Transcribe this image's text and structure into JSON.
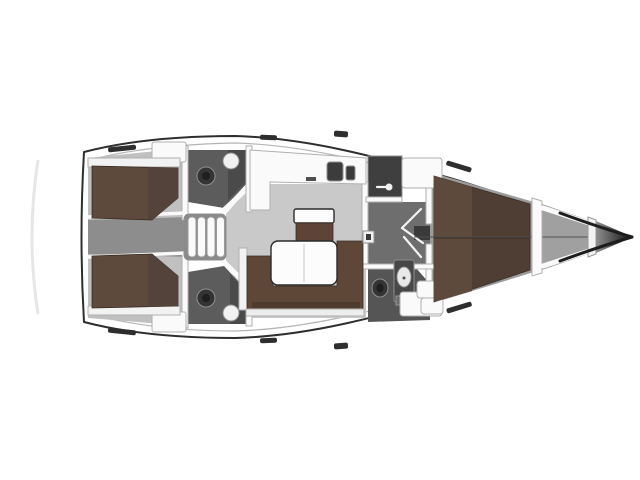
{
  "meta": {
    "kind": "sailing-yacht-interior-floor-plan",
    "view": "top-down",
    "orientation": "bow-right",
    "background": "#ffffff"
  },
  "regions": [
    "hull",
    "swim-platform",
    "aft-cabin-port",
    "aft-cabin-starboard",
    "engine-corridor",
    "companionway-steps",
    "aft-head-port",
    "aft-head-starboard",
    "galley",
    "saloon",
    "nav-station-seat",
    "saloon-table",
    "forward-head",
    "wardrobe",
    "forward-vestibule",
    "forward-cabin-berth",
    "anchor-locker",
    "bow-tip"
  ],
  "palette": {
    "deck_white": "#ffffff",
    "hull_stroke": "#2e2e2e",
    "inner_line": "#b5b5b5",
    "stern_shadow": "#e6e6e6",
    "floor_light": "#c9c9c9",
    "floor_cabin": "#c0c0c0",
    "corridor_gray": "#8d8d8d",
    "vestibule_gray": "#6e6e6e",
    "head_floor": "#5c5c5c",
    "head_floor_mid": "#555555",
    "shower_dark": "#4a4a4a",
    "underlay_gray": "#9b9b9b",
    "locker_gray": "#a0a0a0",
    "bed_brown": "#5d4a3d",
    "bed_brown_dark": "#54433a",
    "berth_brown": "#4f3e34",
    "berth_brown_light": "#5e4a3c",
    "sofa_brown": "#5f4738",
    "sofa_shadow": "#463628",
    "seat_brown": "#5d4436",
    "table_white": "#fcfcfc",
    "wall_white": "#fafafa",
    "wall_stroke": "#b0b0b0",
    "fixture_light": "#f2f2f2",
    "fixture_dark": "#3a3a3a",
    "wardrobe_dark": "#3f3f3f",
    "sink_dark": "#3c3c3c",
    "toilet_dark": "#343434",
    "toilet_inner": "#1f1f1f",
    "basin_white": "#e9e9e9",
    "vanity_gray": "#474747",
    "vent_gray": "#6c6c6c",
    "steps_base": "#8a8a8a",
    "step_bar_white": "#fafafa",
    "base_light": "#ededed",
    "hatch_dark": "#2e2e2e",
    "seam_gray": "#4f4f4f",
    "bow_grad_start": "#8f8f8f",
    "bow_grad_end": "#0d0d0d"
  }
}
